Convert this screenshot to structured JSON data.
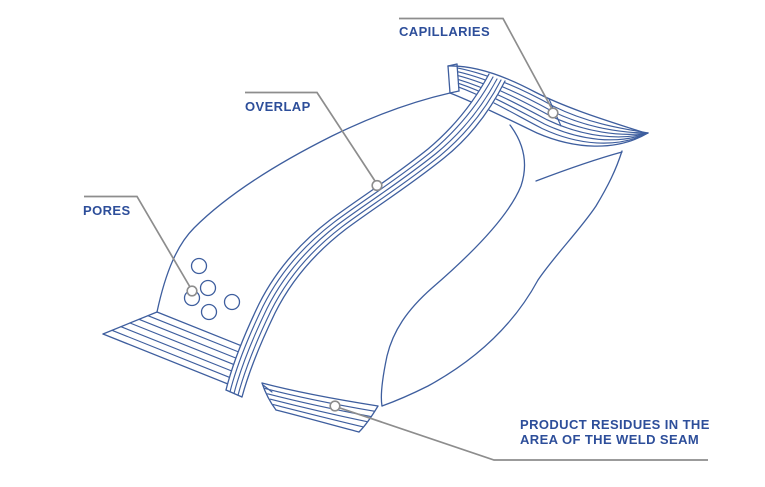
{
  "page": {
    "width": 765,
    "height": 487,
    "background": "#ffffff"
  },
  "colors": {
    "line_blue": "#3e5e9e",
    "label_blue": "#2d4e9a",
    "leader_gray": "#8d8d8d",
    "marker_fill": "#ffffff"
  },
  "diagram": {
    "callouts": {
      "capillaries": {
        "label": "CAPILLARIES"
      },
      "overlap": {
        "label": "OVERLAP"
      },
      "pores": {
        "label": "PORES"
      },
      "product_residues": {
        "label_line1": "PRODUCT RESIDUES IN THE",
        "label_line2": "AREA OF THE WELD SEAM"
      }
    },
    "pore_count": 5
  }
}
